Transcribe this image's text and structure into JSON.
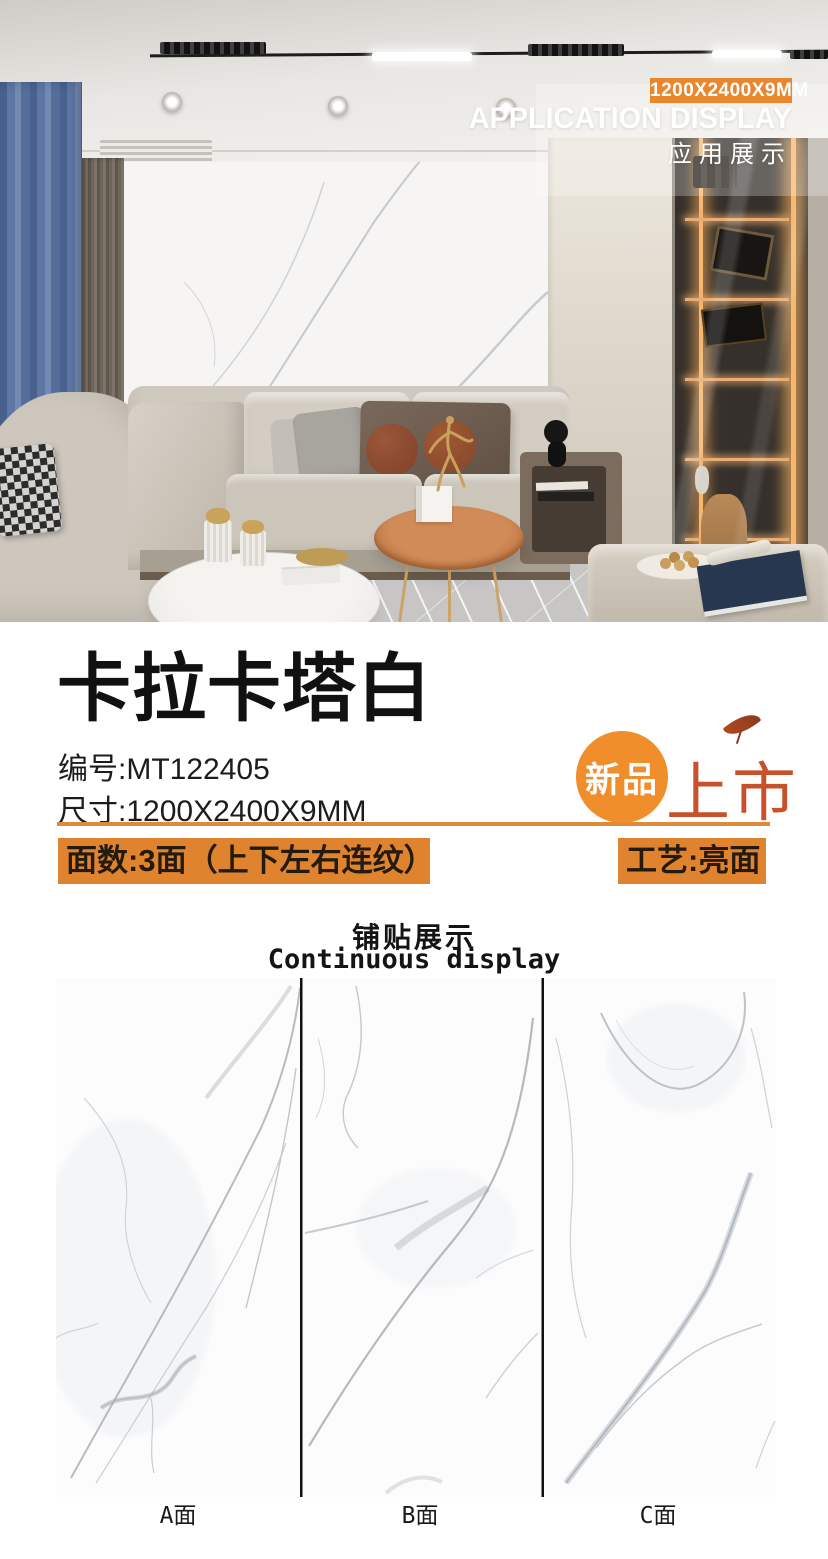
{
  "hero": {
    "size_badge": "1200X2400X9MM",
    "title_en": "APPLICATION DISPLAY",
    "title_zh": "应用展示"
  },
  "product": {
    "name": "卡拉卡塔白",
    "code": {
      "label": "编号:",
      "value": "MT122405"
    },
    "size": {
      "label": "尺寸:",
      "value": "1200X2400X9MM"
    },
    "faces": "面数:3面（上下左右连纹）",
    "finish": "工艺:亮面",
    "badge": {
      "circle_text": "新品",
      "market_text": "上市",
      "leaf_icon": "leaf"
    }
  },
  "display": {
    "title_zh": "铺贴展示",
    "title_en": "Continuous display",
    "panels": [
      {
        "label": "A面"
      },
      {
        "label": "B面"
      },
      {
        "label": "C面"
      }
    ]
  },
  "colors": {
    "accent_orange": "#e0832f",
    "badge_orange": "#e8872e",
    "new_badge_circle": "#ef8e2b",
    "new_badge_text": "#c6512b",
    "divider_black": "#111111",
    "curtain_blue": "#5d76a3"
  }
}
